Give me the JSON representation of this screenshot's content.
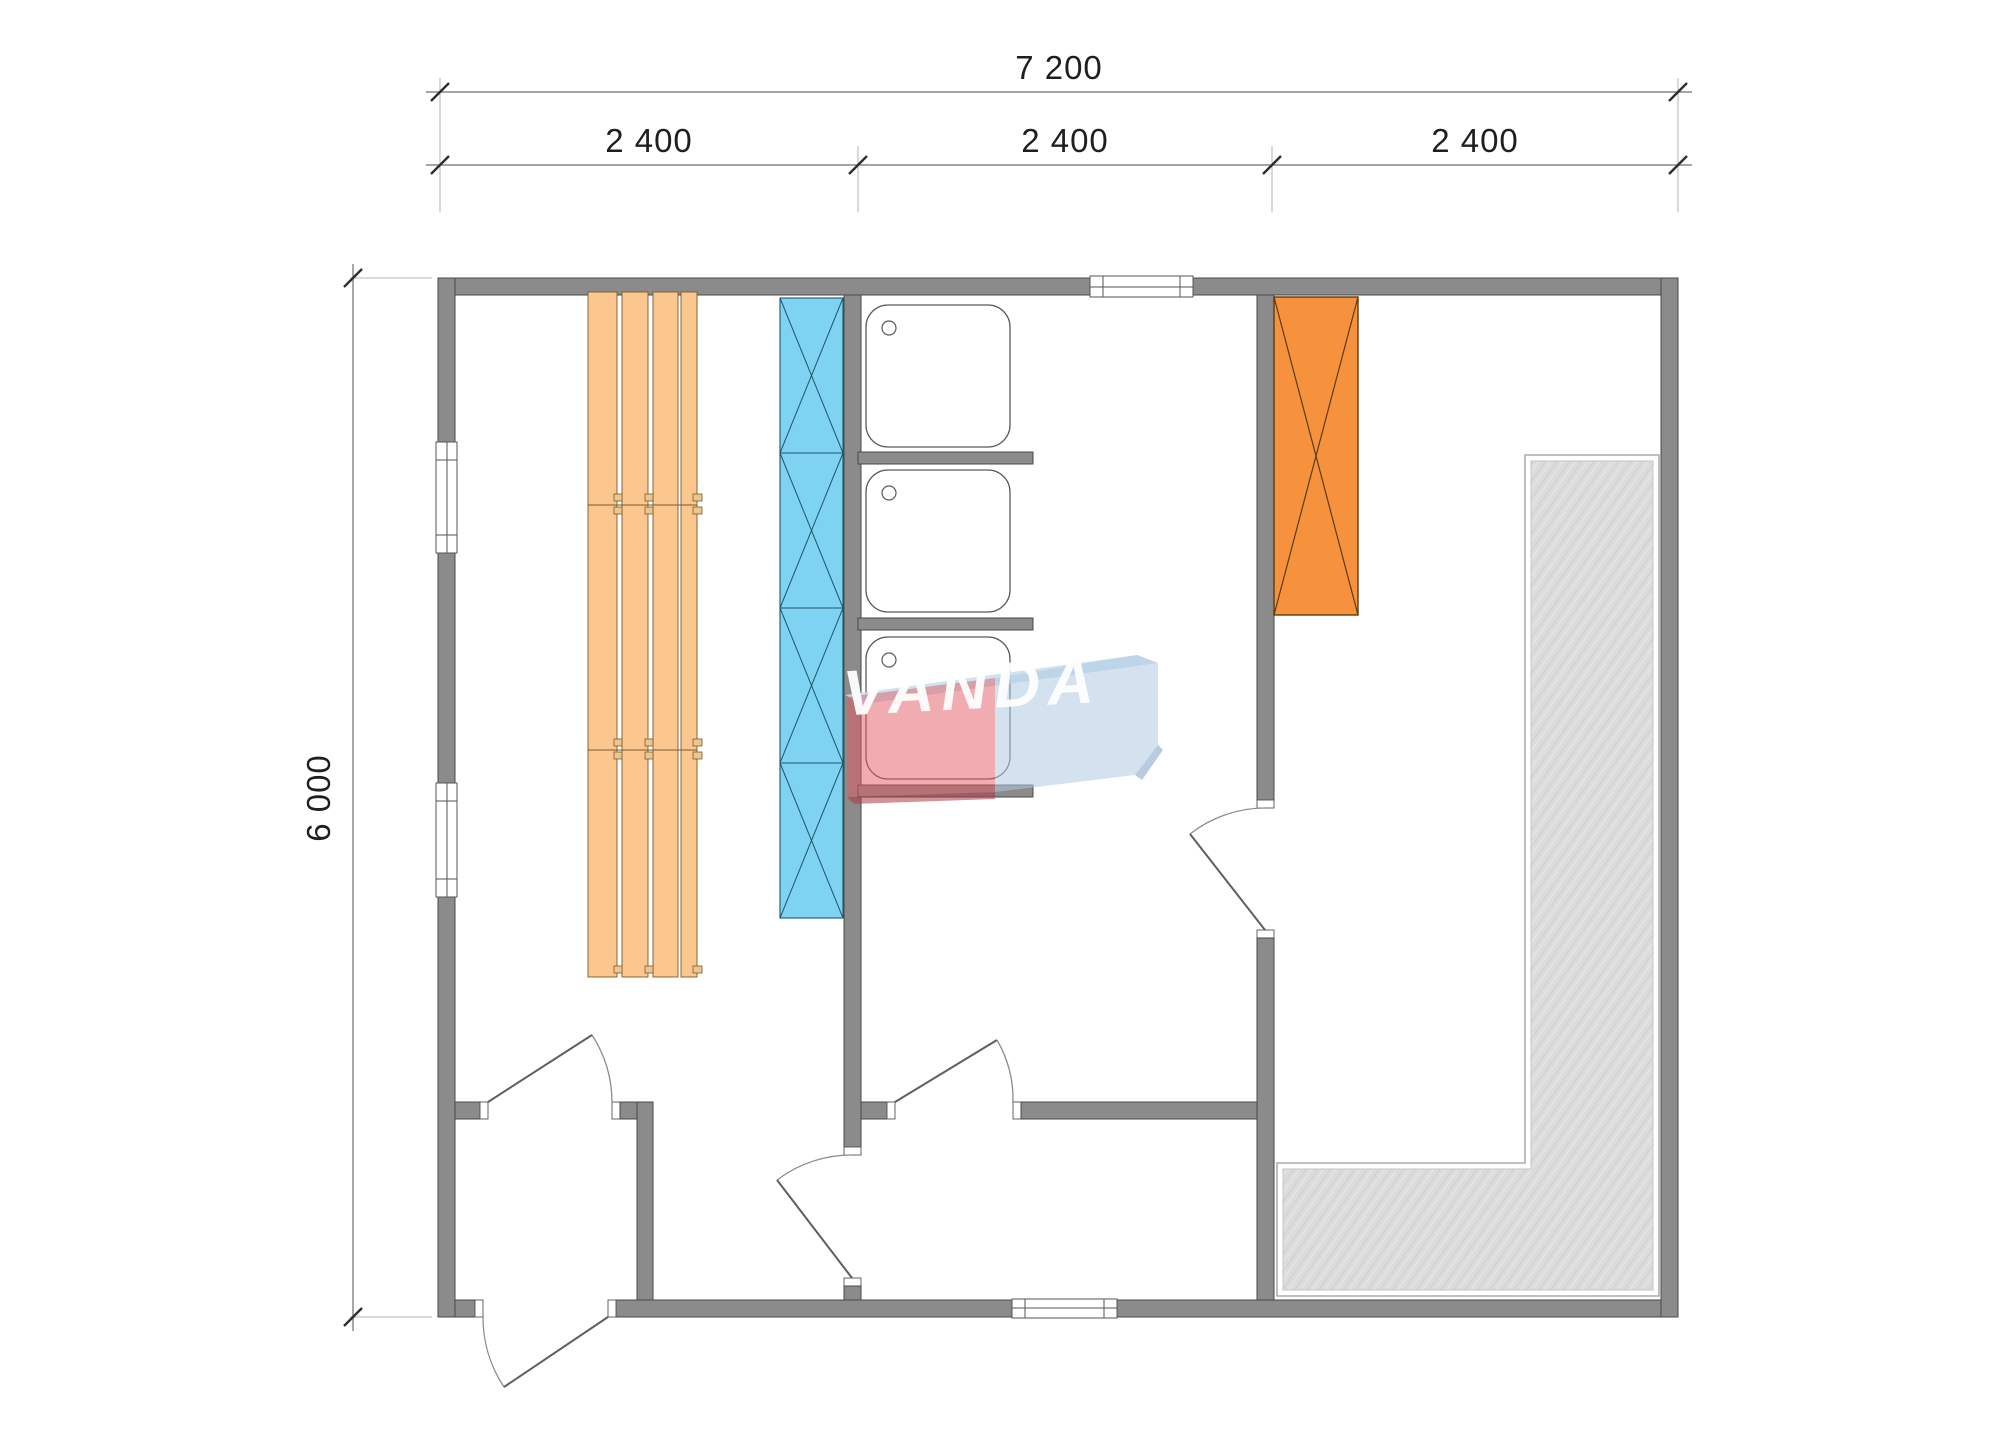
{
  "dimensions": {
    "total_width": "7 200",
    "segments": [
      "2 400",
      "2 400",
      "2 400"
    ],
    "total_height": "6 000"
  },
  "watermark": {
    "text": "VANDA"
  },
  "colors": {
    "wall_fill": "#8b8b8b",
    "wall_outline": "#4a4a4a",
    "cap_fill": "#ffffff",
    "bench_fill": "#fbc78e",
    "bench_outline": "#7a5a2e",
    "bench_clip": "#ecc591",
    "glass_fill": "#7ed2f2",
    "glass_outline": "#20566b",
    "stove_fill": "#f6923d",
    "stove_outline": "#5c3a12",
    "deck_fill": "#dcdcdc",
    "deck_hatch": "#c9c9c9",
    "deck_border": "#9a9a9a",
    "dim_line": "#6f6f6f",
    "dim_tick": "#2e2e2e",
    "dim_text": "#1f1f1f",
    "door_leaf": "#5f5f5f",
    "door_arc": "#8c8c8c",
    "window_outline": "#555555",
    "logo_red": "#e15a64",
    "logo_red_edge": "#ac3a46",
    "logo_blue": "#b1cae2",
    "logo_bevel": "#c5ddee",
    "logo_text": "#ffffff"
  }
}
